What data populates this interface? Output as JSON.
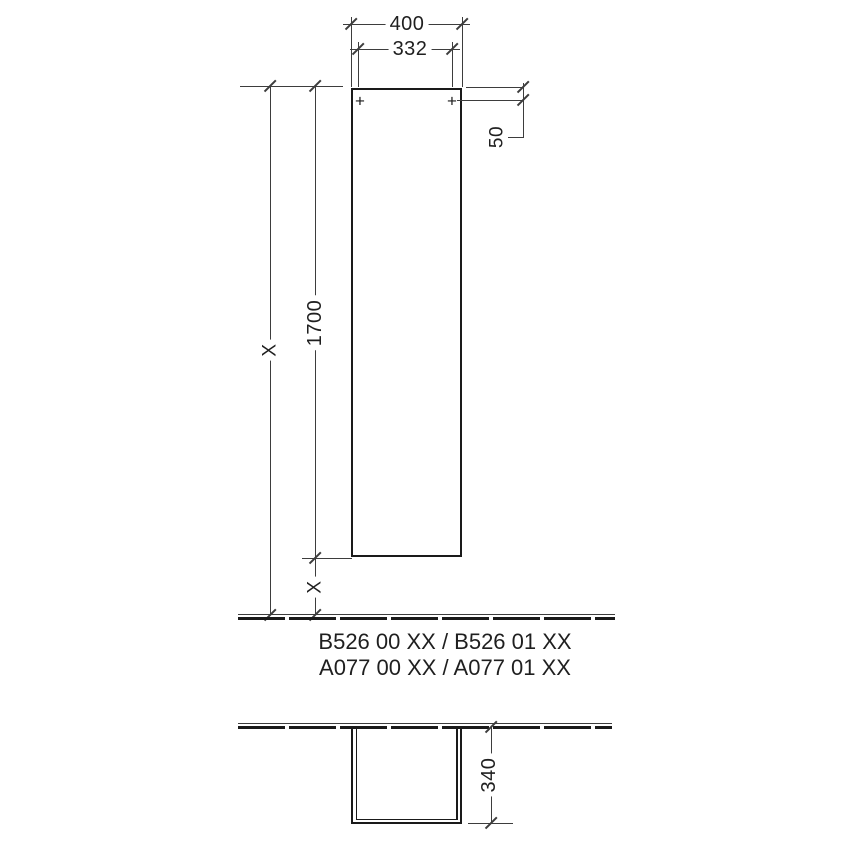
{
  "front_view": {
    "width": "400",
    "hole_spacing": "332",
    "hole_top_offset": "50",
    "cabinet_height": "1700",
    "total_height": "X",
    "floor_clearance": "X"
  },
  "plan_view": {
    "depth": "340"
  },
  "product_codes": {
    "line1": "B526 00 XX / B526 01 XX",
    "line2": "A077 00 XX / A077 01 XX"
  },
  "icons": {
    "mounting_hole_marker": "+"
  },
  "colors": {
    "thin_line": "#3d3d3d",
    "object_line": "#1a1a1a",
    "text": "#1f1f1f",
    "background": "#ffffff"
  }
}
